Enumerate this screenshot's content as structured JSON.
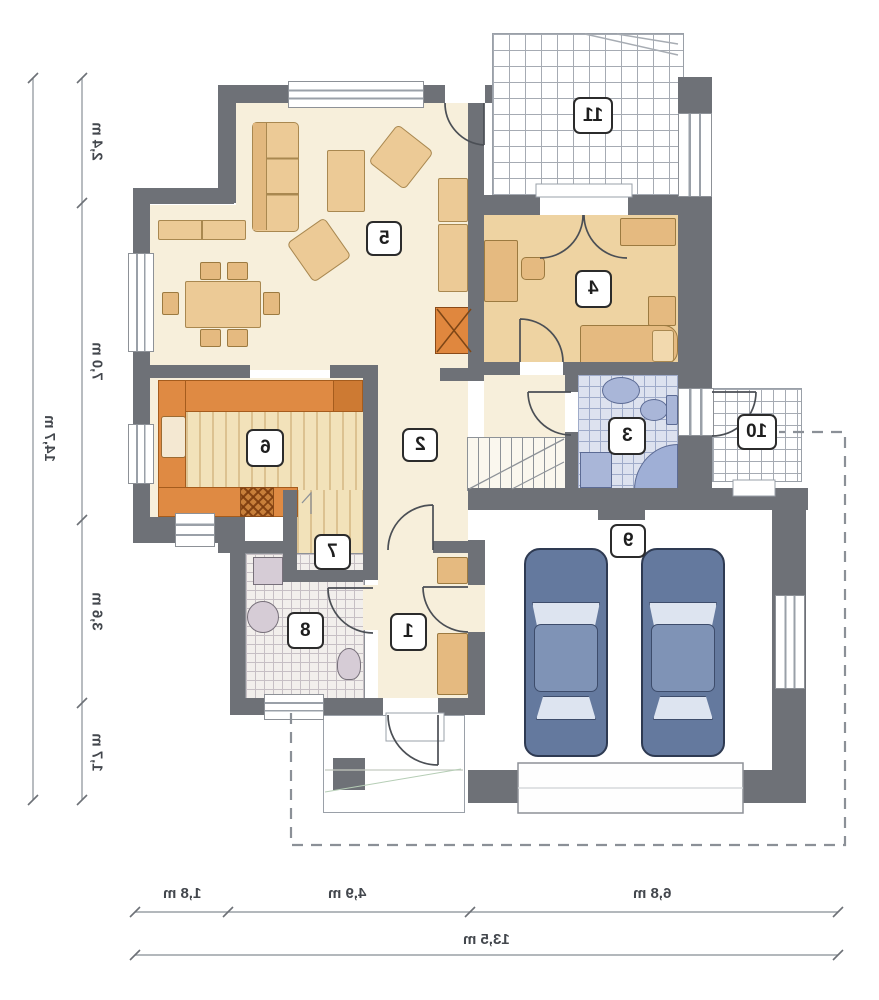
{
  "rooms": {
    "r1": "1",
    "r2": "2",
    "r3": "3",
    "r4": "4",
    "r5": "5",
    "r6": "6",
    "r7": "7",
    "r8": "8",
    "r9": "9",
    "r10": "10",
    "r11": "11"
  },
  "dimensions": {
    "left": {
      "segments": [
        "2,4 m",
        "7,0 m",
        "3,6 m",
        "1,7 m"
      ],
      "total": "14,7 m"
    },
    "bottom": {
      "segments": [
        "1,8 m",
        "4,9 m",
        "6,8 m"
      ],
      "total": "13,5 m"
    }
  },
  "colors": {
    "wall": "#6e7177",
    "floor_cream": "#f7efdb",
    "floor_tan": "#eed3a2",
    "kitchen_counter": "#df8a43",
    "wood_floor": "#f2e2ba",
    "bath_tile": "#dde2ef",
    "fixture_blue": "#a9b6d8",
    "utility_fixture": "#d6ccd6",
    "car_blue": "#64799e",
    "fireplace_orange": "#e0873e",
    "dimension_line": "#9aa0a6",
    "badge_border": "#2b2b2b"
  }
}
